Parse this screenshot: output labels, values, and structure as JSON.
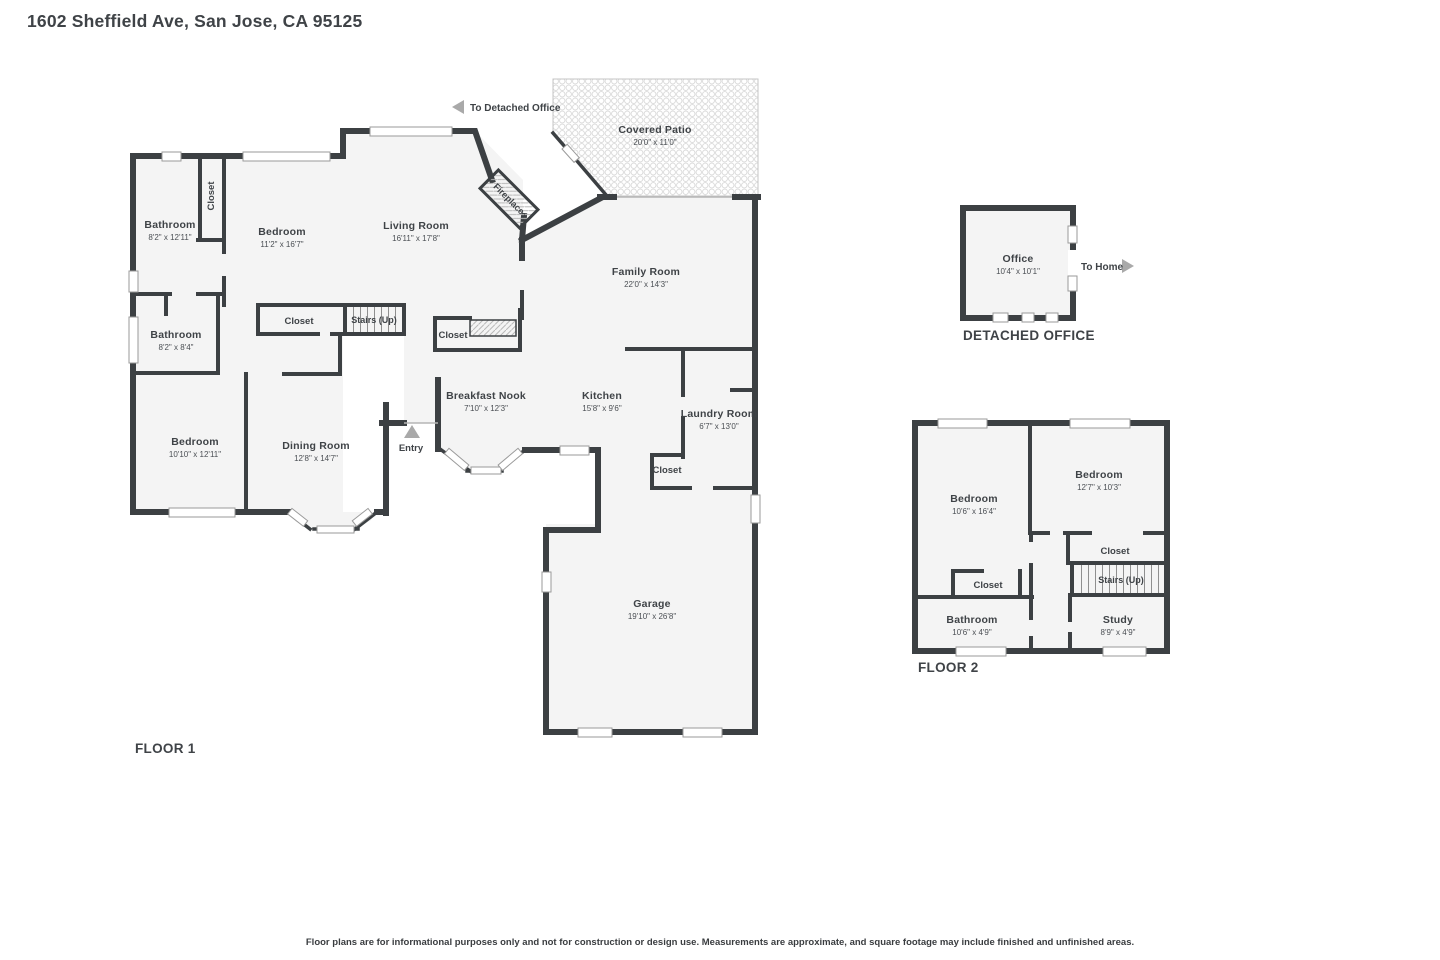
{
  "title": "1602 Sheffield Ave, San Jose, CA 95125",
  "disclaimer": "Floor plans are for informational purposes only and not for construction or design use. Measurements are approximate, and square footage may include finished and unfinished areas.",
  "colors": {
    "wall": "#3c4043",
    "room_fill": "#f4f4f4",
    "text": "#3f4347",
    "arrow": "#a9a9a9"
  },
  "floor1": {
    "label": "FLOOR 1",
    "to_office": "To Detached Office",
    "entry_label": "Entry",
    "fireplace_label": "Fireplace",
    "rooms": {
      "covered_patio": {
        "name": "Covered Patio",
        "dims": "20'0\" x 11'0\""
      },
      "bathroom_front": {
        "name": "Bathroom",
        "dims": "8'2\" x 12'11\""
      },
      "closet_front": {
        "name": "Closet"
      },
      "bedroom_front": {
        "name": "Bedroom",
        "dims": "11'2\" x 16'7\""
      },
      "living_room": {
        "name": "Living Room",
        "dims": "16'11\" x 17'8\""
      },
      "family_room": {
        "name": "Family Room",
        "dims": "22'0\" x 14'3\""
      },
      "bathroom_hall": {
        "name": "Bathroom",
        "dims": "8'2\" x 8'4\""
      },
      "closet_hall": {
        "name": "Closet"
      },
      "stairs": {
        "name": "Stairs (Up)"
      },
      "closet_mid": {
        "name": "Closet"
      },
      "breakfast_nook": {
        "name": "Breakfast Nook",
        "dims": "7'10\" x 12'3\""
      },
      "kitchen": {
        "name": "Kitchen",
        "dims": "15'8\" x 9'6\""
      },
      "laundry": {
        "name": "Laundry Room",
        "dims": "6'7\" x 13'0\""
      },
      "closet_laundry": {
        "name": "Closet"
      },
      "bedroom_back": {
        "name": "Bedroom",
        "dims": "10'10\" x 12'11\""
      },
      "dining": {
        "name": "Dining Room",
        "dims": "12'8\" x 14'7\""
      },
      "garage": {
        "name": "Garage",
        "dims": "19'10\" x 26'8\""
      }
    }
  },
  "detached_office": {
    "label": "DETACHED OFFICE",
    "to_home": "To Home",
    "office": {
      "name": "Office",
      "dims": "10'4\" x 10'1\""
    }
  },
  "floor2": {
    "label": "FLOOR 2",
    "rooms": {
      "bedroom_left": {
        "name": "Bedroom",
        "dims": "10'6\" x 16'4\""
      },
      "bedroom_right": {
        "name": "Bedroom",
        "dims": "12'7\" x 10'3\""
      },
      "closet_right": {
        "name": "Closet"
      },
      "stairs": {
        "name": "Stairs (Up)"
      },
      "closet_left": {
        "name": "Closet"
      },
      "bathroom": {
        "name": "Bathroom",
        "dims": "10'6\" x 4'9\""
      },
      "study": {
        "name": "Study",
        "dims": "8'9\" x 4'9\""
      }
    }
  }
}
